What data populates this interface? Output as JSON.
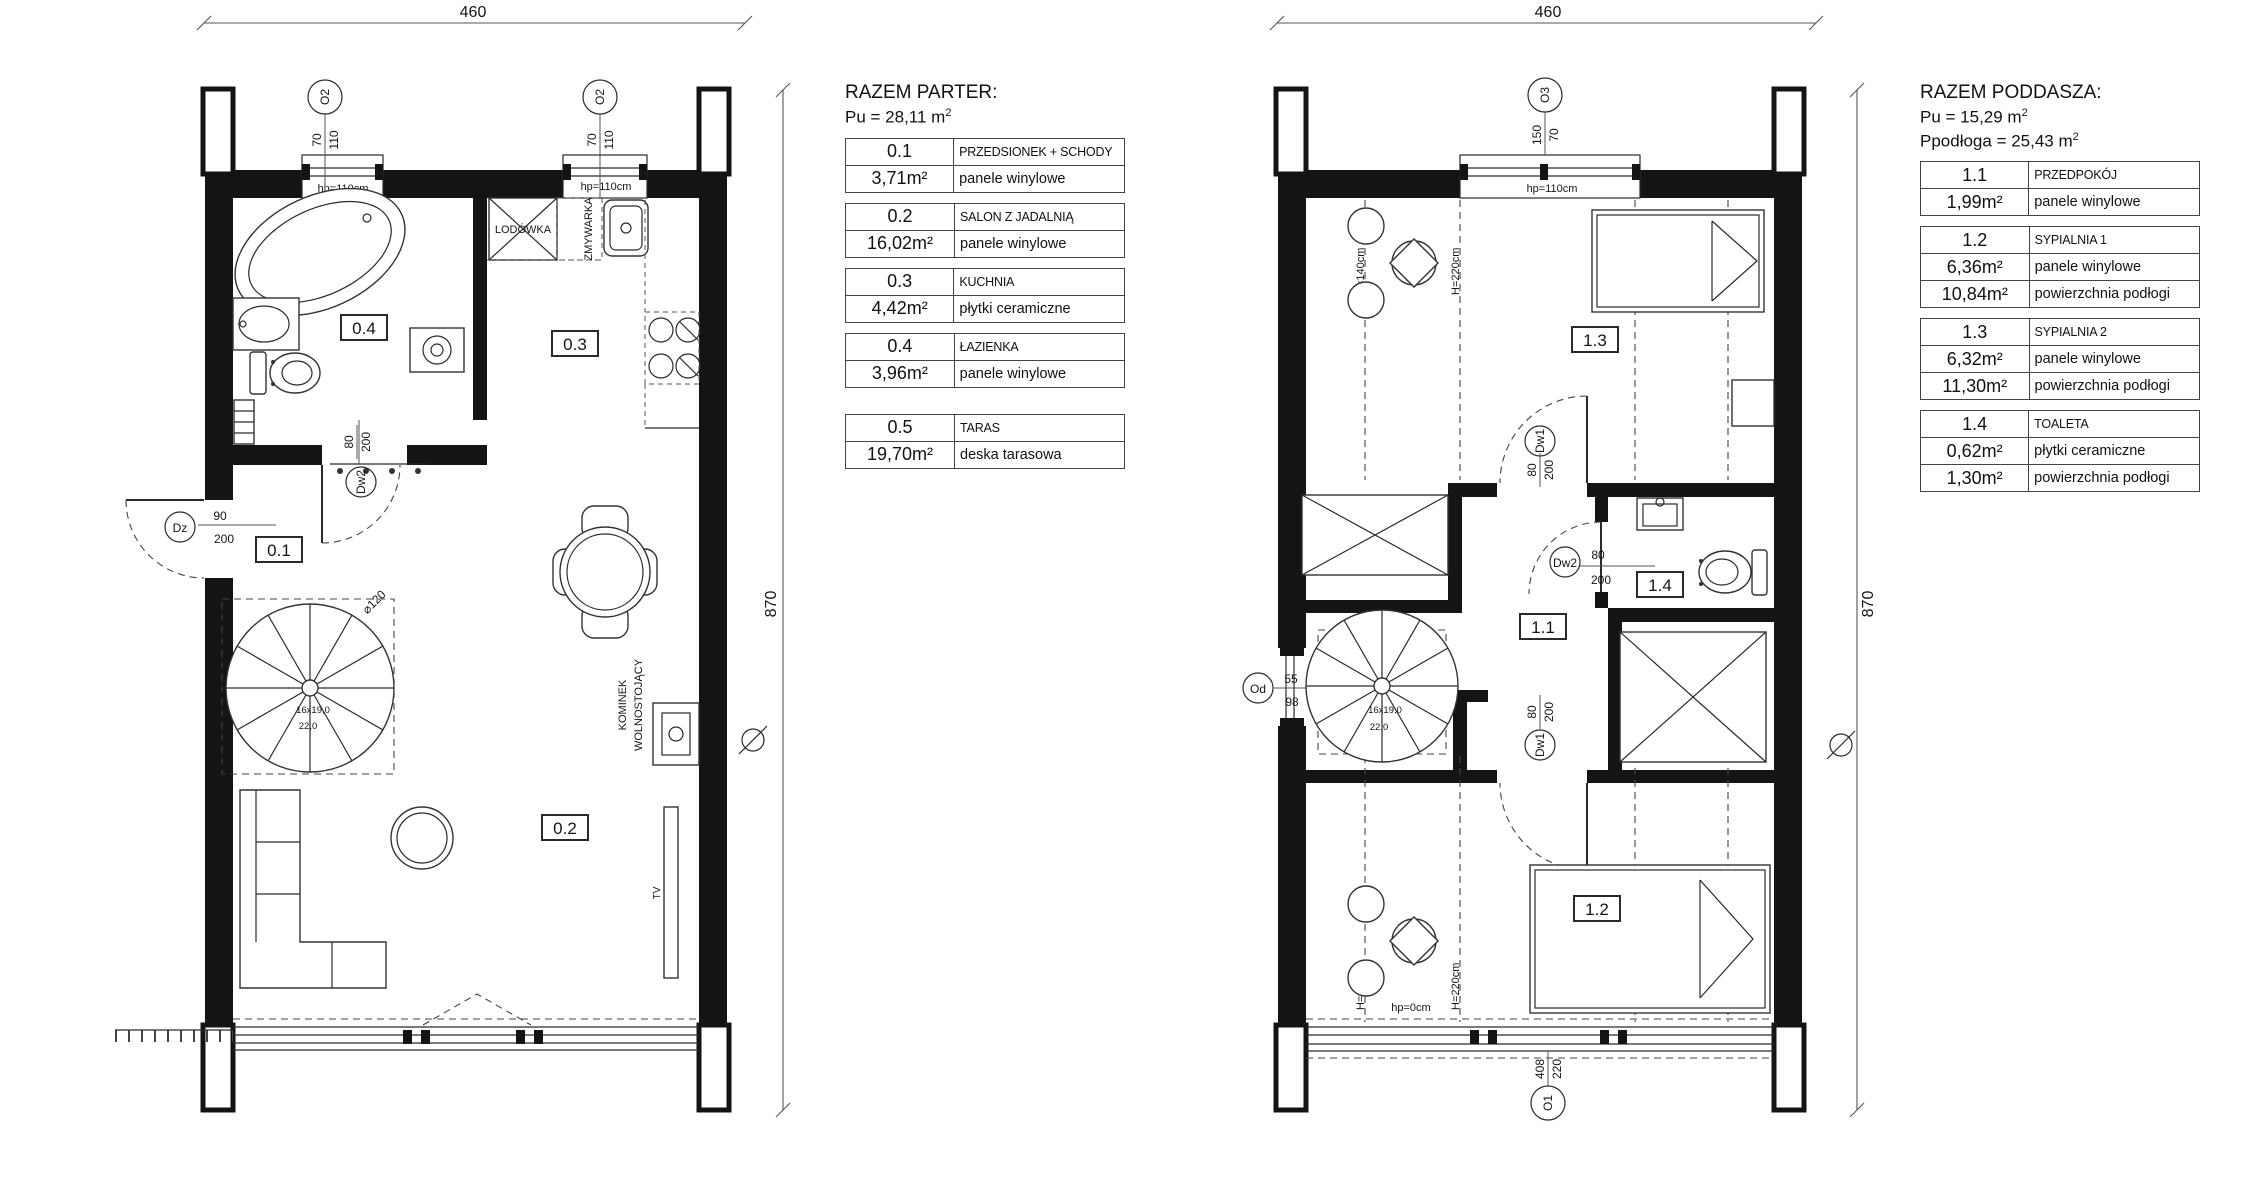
{
  "parter": {
    "dims": {
      "width": "460",
      "height": "870"
    },
    "windows": {
      "o2": "O2",
      "o2_w": "70",
      "o2_h": "110",
      "hp": "hp=110cm"
    },
    "door_main": {
      "tag": "Dz",
      "w": "90",
      "h": "200"
    },
    "door_bath": {
      "tag": "Dw2",
      "w": "80",
      "h": "200"
    },
    "stair": {
      "dia": "⌀120",
      "steps": "16x19,0",
      "width": "22,0"
    },
    "kitchen": {
      "fridge": "LODÓWKA",
      "dishwasher": "ZMYWARKA"
    },
    "living": {
      "tv": "TV",
      "fireplace1": "KOMINEK",
      "fireplace2": "WOLNOSTOJĄCY"
    },
    "room_tags": {
      "r01": "0.1",
      "r02": "0.2",
      "r03": "0.3",
      "r04": "0.4"
    },
    "legend": {
      "title": "RAZEM PARTER:",
      "pu": "Pu = 28,11 m",
      "pu_sup": "2",
      "blocks": [
        {
          "id": "0.1",
          "name": "PRZEDSIONEK + SCHODY",
          "rows": [
            [
              "3,71m²",
              "panele winylowe"
            ]
          ]
        },
        {
          "id": "0.2",
          "name": "SALON Z JADALNIĄ",
          "rows": [
            [
              "16,02m²",
              "panele winylowe"
            ]
          ]
        },
        {
          "id": "0.3",
          "name": "KUCHNIA",
          "rows": [
            [
              "4,42m²",
              "płytki ceramiczne"
            ]
          ]
        },
        {
          "id": "0.4",
          "name": "ŁAZIENKA",
          "rows": [
            [
              "3,96m²",
              "panele winylowe"
            ]
          ]
        },
        {
          "id": "0.5",
          "name": "TARAS",
          "rows": [
            [
              "19,70m²",
              "deska tarasowa"
            ]
          ]
        }
      ]
    }
  },
  "poddasze": {
    "dims": {
      "width": "460",
      "height": "870"
    },
    "windows": {
      "o3": "O3",
      "o3_w": "150",
      "o3_h": "70",
      "hp_top": "hp=110cm",
      "hp_bottom": "hp=0cm",
      "o1": "O1",
      "o1_w": "408",
      "o1_h": "220",
      "od": "Od",
      "od_w": "55",
      "od_h": "98"
    },
    "doors": {
      "dw1": "Dw1",
      "dw2": "Dw2",
      "w80": "80",
      "h200": "200"
    },
    "stair": {
      "steps": "16x19,0",
      "width": "22,0"
    },
    "heights": {
      "h140": "H=140cm",
      "h220": "H=220cm"
    },
    "room_tags": {
      "r11": "1.1",
      "r12": "1.2",
      "r13": "1.3",
      "r14": "1.4"
    },
    "legend": {
      "title": "RAZEM PODDASZA:",
      "pu": "Pu = 15,29 m",
      "pu_sup": "2",
      "pfloor": "Ppodłoga = 25,43 m",
      "pfloor_sup": "2",
      "blocks": [
        {
          "id": "1.1",
          "name": "PRZEDPOKÓJ",
          "rows": [
            [
              "1,99m²",
              "panele winylowe"
            ]
          ]
        },
        {
          "id": "1.2",
          "name": "SYPIALNIA 1",
          "rows": [
            [
              "6,36m²",
              "panele winylowe"
            ],
            [
              "10,84m²",
              "powierzchnia podłogi"
            ]
          ]
        },
        {
          "id": "1.3",
          "name": "SYPIALNIA 2",
          "rows": [
            [
              "6,32m²",
              "panele winylowe"
            ],
            [
              "11,30m²",
              "powierzchnia podłogi"
            ]
          ]
        },
        {
          "id": "1.4",
          "name": "TOALETA",
          "rows": [
            [
              "0,62m²",
              "płytki ceramiczne"
            ],
            [
              "1,30m²",
              "powierzchnia podłogi"
            ]
          ]
        }
      ]
    }
  }
}
